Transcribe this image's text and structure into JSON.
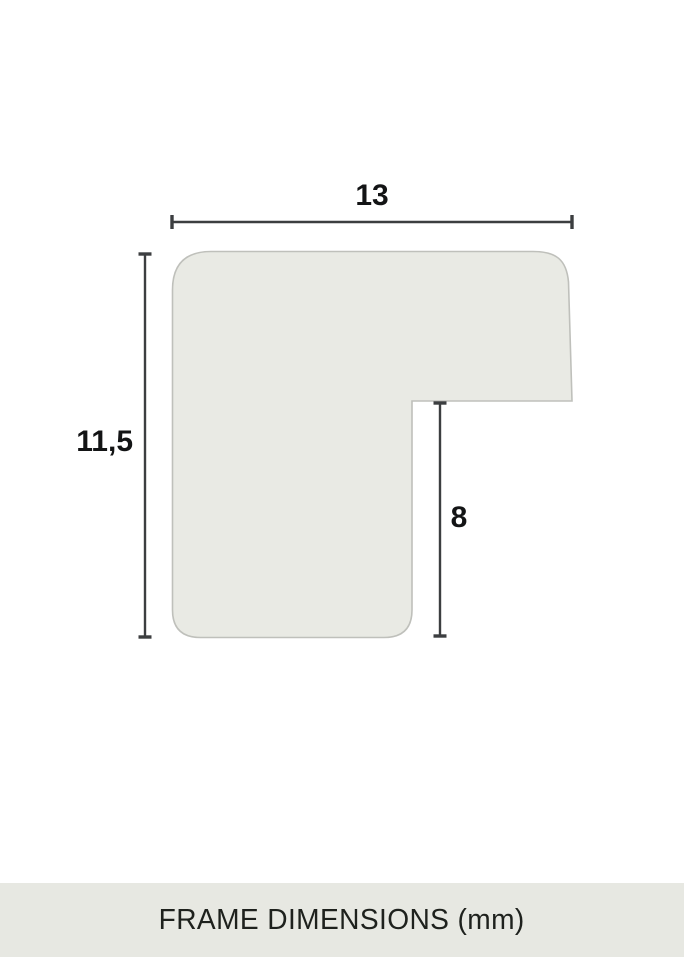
{
  "diagram": {
    "title_semantic": "frame-moulding-profile-cross-section",
    "unit": "mm",
    "dimensions": {
      "width": {
        "label": "13",
        "value": 13
      },
      "height": {
        "label": "11,5",
        "value": 11.5
      },
      "rabbet_depth": {
        "label": "8",
        "value": 8
      }
    },
    "colors": {
      "shape_fill": "#e9eae4",
      "shape_border": "#bfc0bb",
      "dimension_line": "#3c3e40",
      "label_text": "#131415"
    }
  },
  "footer": {
    "title": "FRAME DIMENSIONS (mm)",
    "background": "#e7e8e2",
    "text_color": "#1e211d"
  }
}
